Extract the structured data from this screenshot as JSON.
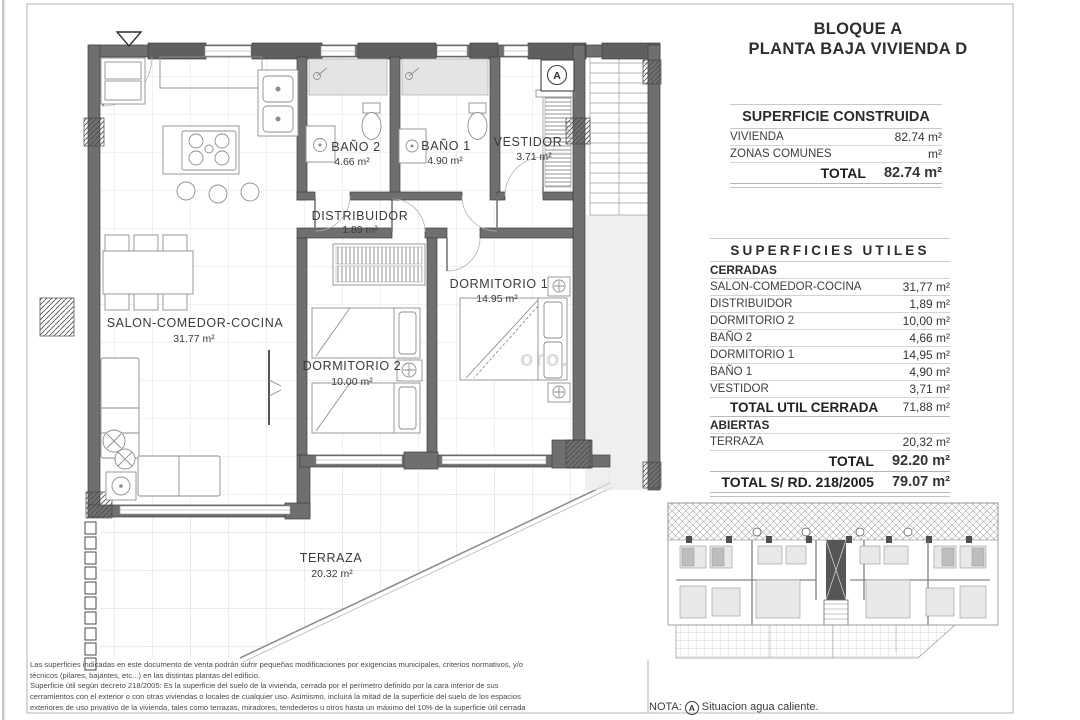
{
  "title": {
    "line1": "BLOQUE A",
    "line2": "PLANTA BAJA VIVIENDA D"
  },
  "surface_built": {
    "header": "SUPERFICIE CONSTRUIDA",
    "rows": [
      {
        "label": "VIVIENDA",
        "value": "82.74 m²"
      },
      {
        "label": "ZONAS COMUNES",
        "value": "m²"
      }
    ],
    "total_label": "TOTAL",
    "total_value": "82.74 m²"
  },
  "surfaces_useful": {
    "header": "SUPERFICIES UTILES",
    "cerradas": "CERRADAS",
    "rows": [
      {
        "label": "SALON-COMEDOR-COCINA",
        "value": "31,77 m²"
      },
      {
        "label": "DISTRIBUIDOR",
        "value": "1,89 m²"
      },
      {
        "label": "DORMITORIO 2",
        "value": "10,00 m²"
      },
      {
        "label": "BAÑO 2",
        "value": "4,66 m²"
      },
      {
        "label": "DORMITORIO 1",
        "value": "14,95 m²"
      },
      {
        "label": "BAÑO 1",
        "value": "4,90 m²"
      },
      {
        "label": "VESTIDOR",
        "value": "3,71 m²"
      }
    ],
    "total_cerrada_label": "TOTAL UTIL CERRADA",
    "total_cerrada_value": "71,88 m²",
    "abiertas": "ABIERTAS",
    "abiertas_rows": [
      {
        "label": "TERRAZA",
        "value": "20,32 m²"
      }
    ],
    "total_label": "TOTAL",
    "total_value": "92.20 m²",
    "total_rd_label": "TOTAL S/ RD. 218/2005",
    "total_rd_value": "79.07 m²"
  },
  "plan": {
    "rooms": [
      {
        "name": "BAÑO 2",
        "area": "4.66 m²"
      },
      {
        "name": "BAÑO 1",
        "area": "4.90 m²"
      },
      {
        "name": "VESTIDOR",
        "area": "3.71 m²"
      },
      {
        "name": "DISTRIBUIDOR",
        "area": "1.89 m²"
      },
      {
        "name": "SALON-COMEDOR-COCINA",
        "area": "31.77 m²"
      },
      {
        "name": "DORMITORIO 2",
        "area": "10.00 m²"
      },
      {
        "name": "DORMITORIO 1",
        "area": "14.95 m²"
      },
      {
        "name": "TERRAZA",
        "area": "20.32 m²"
      }
    ],
    "hot_water_symbol": "A",
    "watermark": "oro."
  },
  "note": {
    "prefix": "NOTA:",
    "symbol": "A",
    "text": "Situacion agua caliente."
  },
  "disclaimer": {
    "lines": [
      "Las superficies indicadas en este documento de venta podrán sufrir pequeñas modificaciones por exigencias municipales, criterios normativos, y/o",
      "técnicos (pilares, bajantes, etc...) en las distintas plantas del edificio.",
      "Superficie útil según decreto 218/2005: Es la superficie del suelo de la vivienda, cerrada por el perímetro definido por la cara interior de sus",
      "cerramientos con el exterior o con otras viviendas o locales de cualquier uso. Asimismo, incluirá la mitad de la superficie del suelo de los espacios",
      "exteriores de uso privativo de la vivienda, tales como terrazas, miradores, tendederos u otros hasta un máximo del 10% de la superficie útil cerrada"
    ]
  }
}
